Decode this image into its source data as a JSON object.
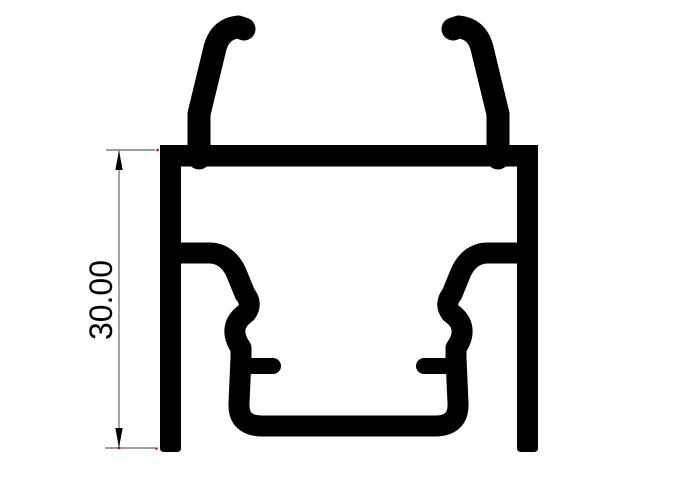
{
  "drawing": {
    "dimension": {
      "label": "30.00"
    },
    "colors": {
      "profile": "#000000",
      "dimension_line": "#7d7d7d",
      "arrow": "#000000",
      "text": "#000000",
      "endpoint_marker": "#d40000",
      "background": "#ffffff"
    }
  }
}
